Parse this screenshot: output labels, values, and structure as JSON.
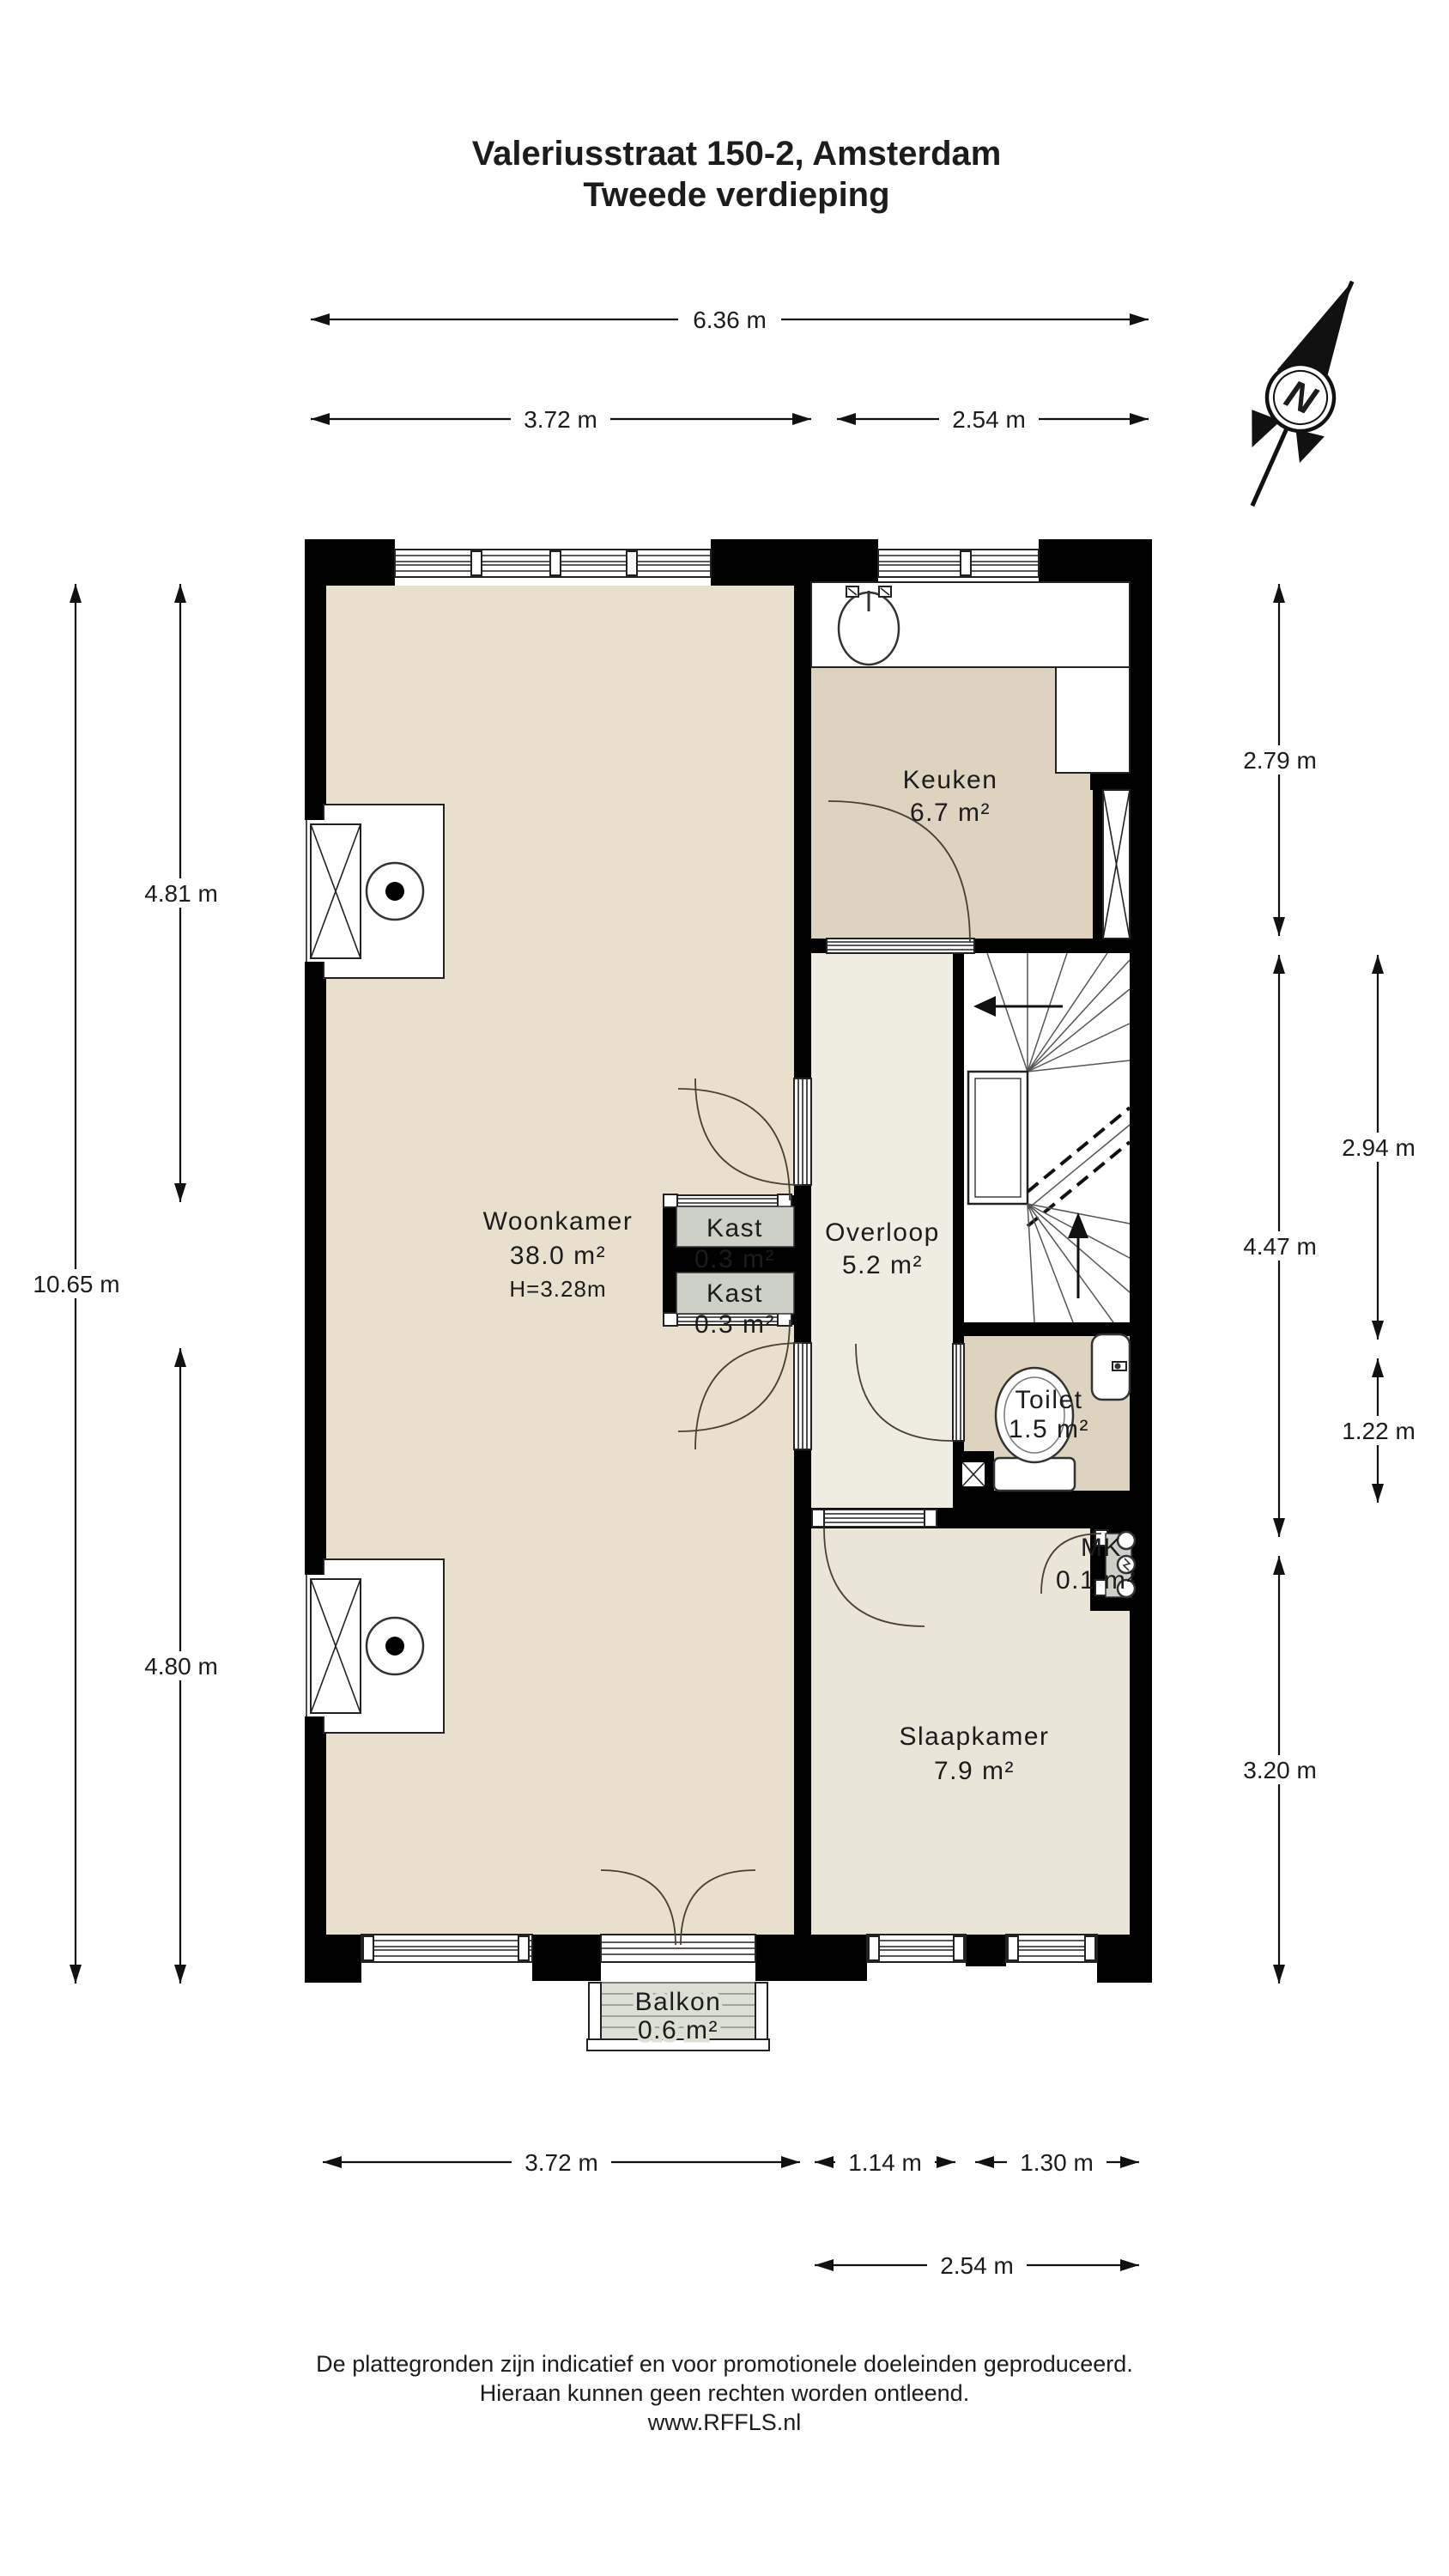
{
  "title": {
    "line1": "Valeriusstraat 150-2, Amsterdam",
    "line2": "Tweede verdieping"
  },
  "compass": {
    "north_label": "N"
  },
  "rooms": {
    "woonkamer": {
      "name": "Woonkamer",
      "area": "38.0 m²",
      "ceiling_height": "H=3.28m"
    },
    "keuken": {
      "name": "Keuken",
      "area": "6.7 m²"
    },
    "overloop": {
      "name": "Overloop",
      "area": "5.2 m²"
    },
    "kast_boven": {
      "name": "Kast",
      "area": "0.3 m²"
    },
    "kast_onder": {
      "name": "Kast",
      "area": "0.3 m²"
    },
    "toilet": {
      "name": "Toilet",
      "area": "1.5 m²"
    },
    "mk": {
      "name": "MK",
      "area": "0.1 m²"
    },
    "slaapkamer": {
      "name": "Slaapkamer",
      "area": "7.9 m²"
    },
    "balkon": {
      "name": "Balkon",
      "area": "0.6 m²"
    }
  },
  "dimensions": {
    "top_total": "6.36 m",
    "top_left": "3.72 m",
    "top_right": "2.54 m",
    "left_upper": "4.81 m",
    "left_total": "10.65 m",
    "left_lower": "4.80 m",
    "right_upper": "2.79 m",
    "right_middle": "4.47 m",
    "right_lower": "3.20 m",
    "right_inner_upper": "2.94 m",
    "right_inner_lower": "1.22 m",
    "bottom_left": "3.72 m",
    "bottom_middle": "1.14 m",
    "bottom_right": "1.30 m",
    "bottom_total": "2.54 m"
  },
  "footer": {
    "line1": "De plattegronden zijn indicatief en voor promotionele doeleinden geproduceerd.",
    "line2": "Hieraan kunnen geen rechten worden ontleend.",
    "line3": "www.RFFLS.nl"
  },
  "colors": {
    "wall": "#000000",
    "living_fill": "#e8e0cd",
    "kitchen_fill": "#ddd3bf",
    "hall_fill": "#efece2",
    "bedroom_fill": "#ebe5d7",
    "closet_fill": "#ccd0c7",
    "balcony_fill": "#dcdfd4"
  }
}
